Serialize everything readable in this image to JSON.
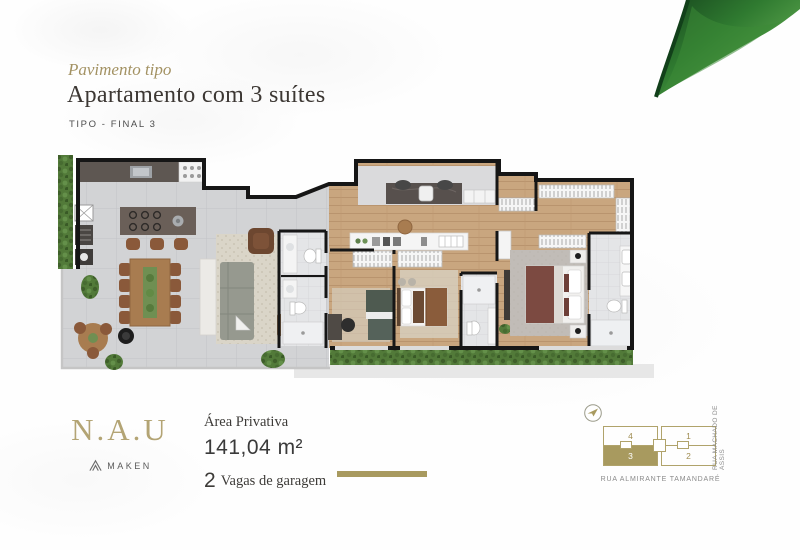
{
  "header": {
    "eyebrow": "Pavimento tipo",
    "title": "Apartamento com 3 suítes",
    "type_label": "TIPO - FINAL 3"
  },
  "footer": {
    "brand": "N.A.U",
    "brand_maker": "MAKEN",
    "area_label": "Área Privativa",
    "area_value": "141,04 m²",
    "garage_number": "2",
    "garage_label": "Vagas de garagem"
  },
  "siteplan": {
    "units": [
      {
        "label": "1",
        "highlighted": false
      },
      {
        "label": "2",
        "highlighted": false
      },
      {
        "label": "3",
        "highlighted": true
      },
      {
        "label": "4",
        "highlighted": false
      }
    ],
    "highlighted_unit": "3",
    "street_side": "RUA MACHADO DE ASSIS",
    "street_bottom": "RUA ALMIRANTE TAMANDARÉ"
  },
  "colors": {
    "accent_gold": "#a89a5f",
    "logo_gold": "#b3a474",
    "title_dark": "#3c3733",
    "wall_black": "#161616",
    "wood_floor": "#c9a67f",
    "terrace_tile": "#d2d3d5",
    "hedge_green": "#527a39",
    "leaf_dark": "#1a4d20",
    "leaf_light": "#5ba34b"
  }
}
